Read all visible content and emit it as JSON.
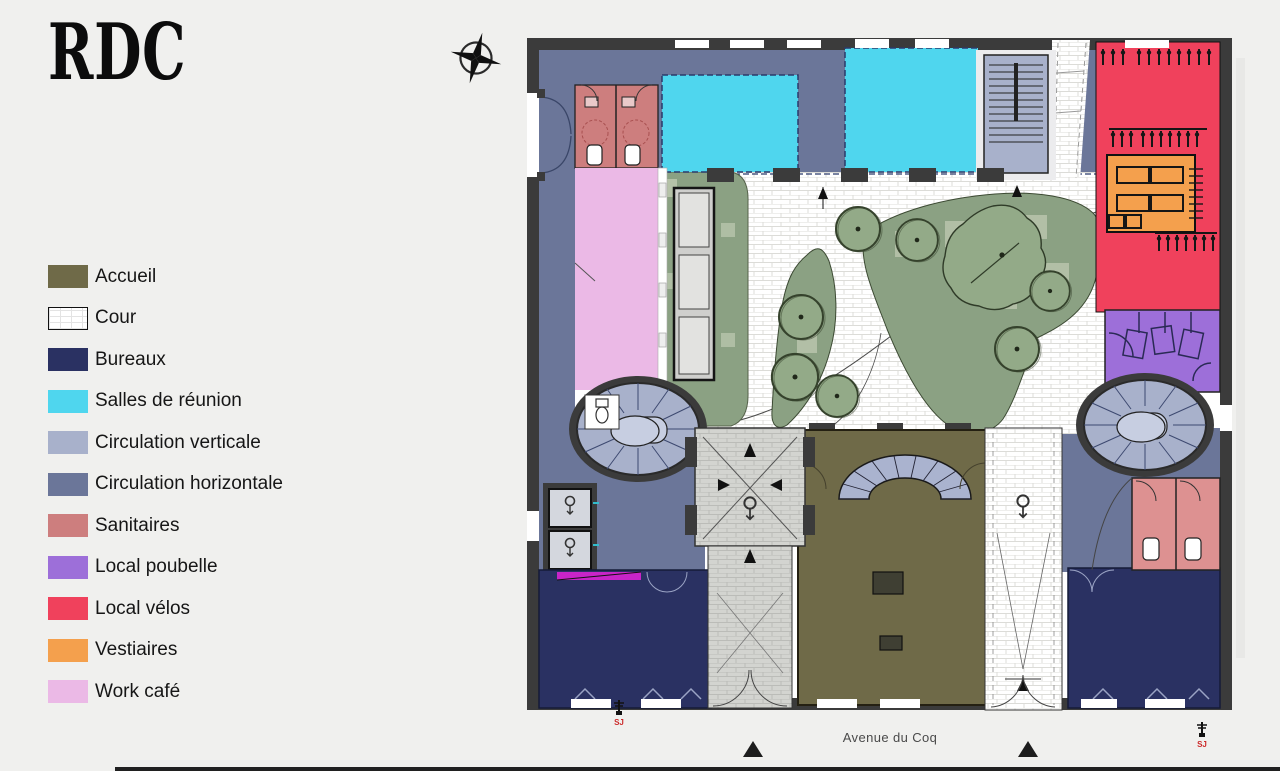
{
  "title": "RDC",
  "legend": {
    "items": [
      {
        "key": "accueil",
        "label": "Accueil",
        "color": "#6f6a48"
      },
      {
        "key": "cour",
        "label": "Cour",
        "color": "#ffffff"
      },
      {
        "key": "bureaux",
        "label": "Bureaux",
        "color": "#2a3162"
      },
      {
        "key": "reunion",
        "label": "Salles de réunion",
        "color": "#4fd6ee"
      },
      {
        "key": "circv",
        "label": "Circulation verticale",
        "color": "#a8b1cb"
      },
      {
        "key": "circh",
        "label": "Circulation horizontale",
        "color": "#6b7699"
      },
      {
        "key": "sanitaires",
        "label": "Sanitaires",
        "color": "#cd7e7e"
      },
      {
        "key": "poubelle",
        "label": "Local poubelle",
        "color": "#9d6fd9"
      },
      {
        "key": "velos",
        "label": "Local vélos",
        "color": "#f0415c"
      },
      {
        "key": "vestiaires",
        "label": "Vestiaires",
        "color": "#f4a04d"
      },
      {
        "key": "workcafe",
        "label": "Work café",
        "color": "#ebb9e6"
      }
    ]
  },
  "plan": {
    "street_label": "Avenue du Coq",
    "markers": {
      "left": "SJ",
      "right": "SJ"
    },
    "colors": {
      "wall": "#3b3b3b",
      "floor": "#ffffff",
      "planting": "#8ba183",
      "planting_light": "#bfcab2",
      "tree": "#93aa88",
      "tree_outline": "#35422c",
      "paving_line": "#dcdcd8",
      "entrance_paving": "#d3d4d0",
      "entrance_line": "#bbbcb8",
      "stair_tread": "#aab3cf",
      "stair_platform": "#c7cee1",
      "sanitaires_light": "#dd9191",
      "magenta_accent": "#c824c8",
      "navy_line": "#2b3a6b"
    }
  }
}
